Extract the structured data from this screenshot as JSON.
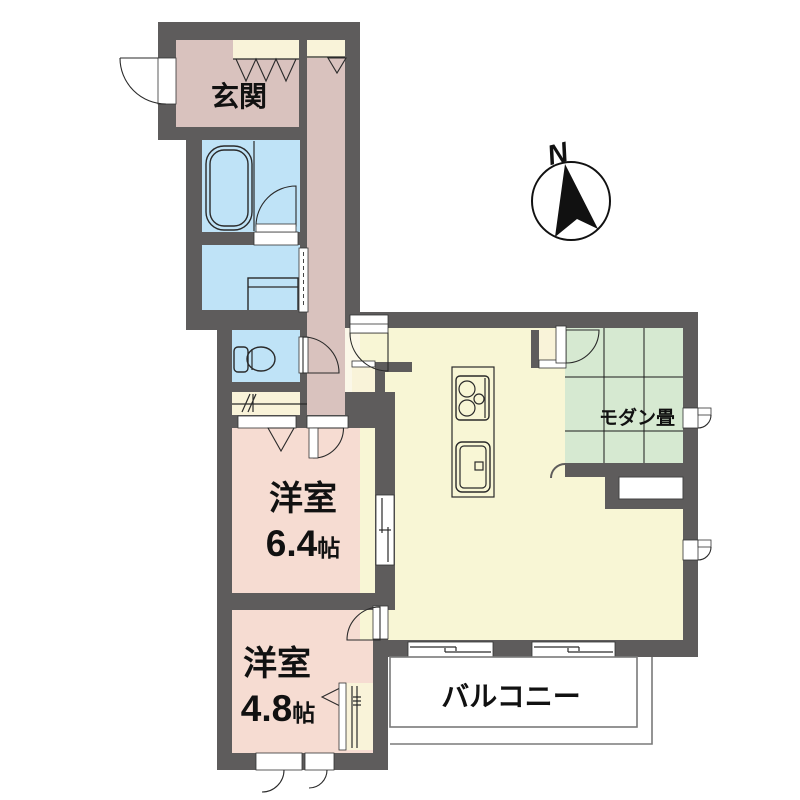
{
  "floorplan": {
    "type": "apartment-floor-plan",
    "labels": {
      "entrance": "玄関",
      "modern_tatami": "モダン畳",
      "western_room_1_name": "洋室",
      "western_room_1_size": "6.4",
      "western_room_1_unit": "帖",
      "western_room_2_name": "洋室",
      "western_room_2_size": "4.8",
      "western_room_2_unit": "帖",
      "balcony": "バルコニー",
      "compass_north": "N"
    },
    "colors": {
      "wall": "#5e5c5c",
      "entrance_hall": "#d9c2be",
      "western_room": "#f6dcd2",
      "water_area": "#bfe3f7",
      "ldk": "#f8f6d5",
      "closet": "#f9f3d9",
      "tatami": "#d6e9d1",
      "door_swing_pink": "#f3ded7",
      "passage": "#fbf7e8",
      "balcony_line": "#7a7a7a",
      "ink": "#111111"
    }
  }
}
